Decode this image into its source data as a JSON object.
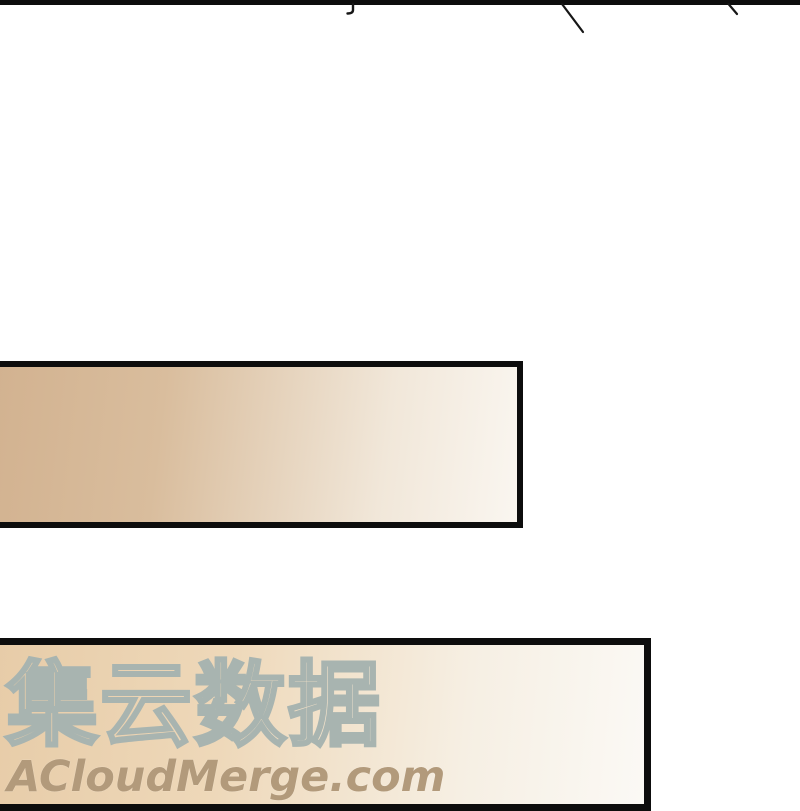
{
  "watermark": {
    "cjk_text": "集云数据",
    "url_text": "ACloudMerge.com"
  },
  "colors": {
    "panel_border": "#0d0d0d",
    "box1_fill_left": "#d2b290",
    "box1_fill_right": "#faf6f0",
    "box2_fill_left": "#e7cca8",
    "box2_fill_right": "#fbf9f5",
    "watermark_outline": "#a8b4b0",
    "watermark_url": "#b29a7b",
    "mark_stroke": "#161616"
  }
}
